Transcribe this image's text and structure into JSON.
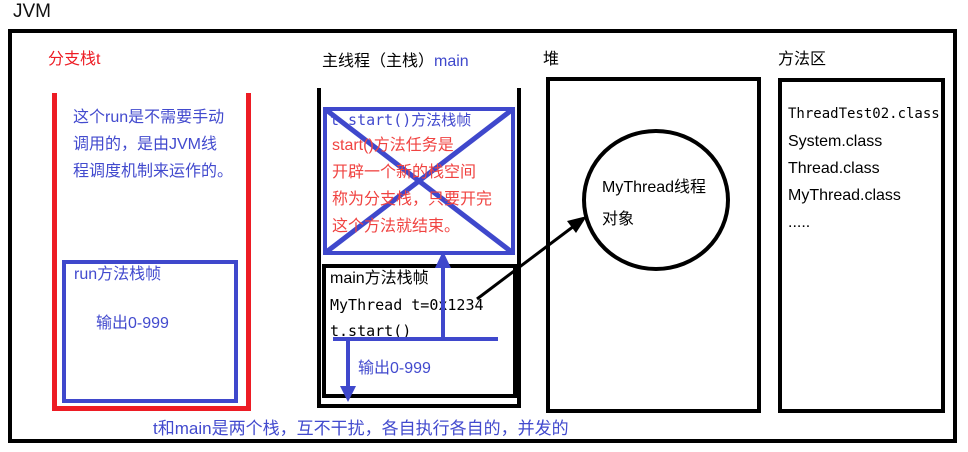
{
  "title": "JVM",
  "branch_stack": {
    "label": "分支栈t",
    "note_lines": [
      "这个run是不需要手动",
      "调用的，是由JVM线",
      "程调度机制来运作的。"
    ],
    "run_frame": {
      "title": "run方法栈帧",
      "output": "输出0-999"
    }
  },
  "main_stack": {
    "label_black": "主线程（主栈）",
    "label_blue": "main",
    "start_frame": {
      "title_code": "t.start()",
      "title_rest": "方法栈帧",
      "note_lines": [
        "start()方法任务是",
        "开辟一个新的栈空间",
        "称为分支栈，只要开完",
        "这个方法就结束。"
      ]
    },
    "main_frame": {
      "title": "main方法栈帧",
      "code_lines": [
        "MyThread t=0x1234",
        "t.start()"
      ],
      "output": "输出0-999"
    }
  },
  "heap": {
    "label": "堆",
    "object_lines": [
      "MyThread线程",
      "对象"
    ]
  },
  "method_area": {
    "label": "方法区",
    "classes": [
      "ThreadTest02.class",
      "System.class",
      "Thread.class",
      "MyThread.class",
      "....."
    ]
  },
  "footer_note": "t和main是两个栈，互不干扰，各自执行各自的，并发的",
  "colors": {
    "black": "#000000",
    "red": "#ed1c24",
    "red_text": "#f04341",
    "blue": "#3f48cc",
    "blue_text": "#424ace"
  }
}
